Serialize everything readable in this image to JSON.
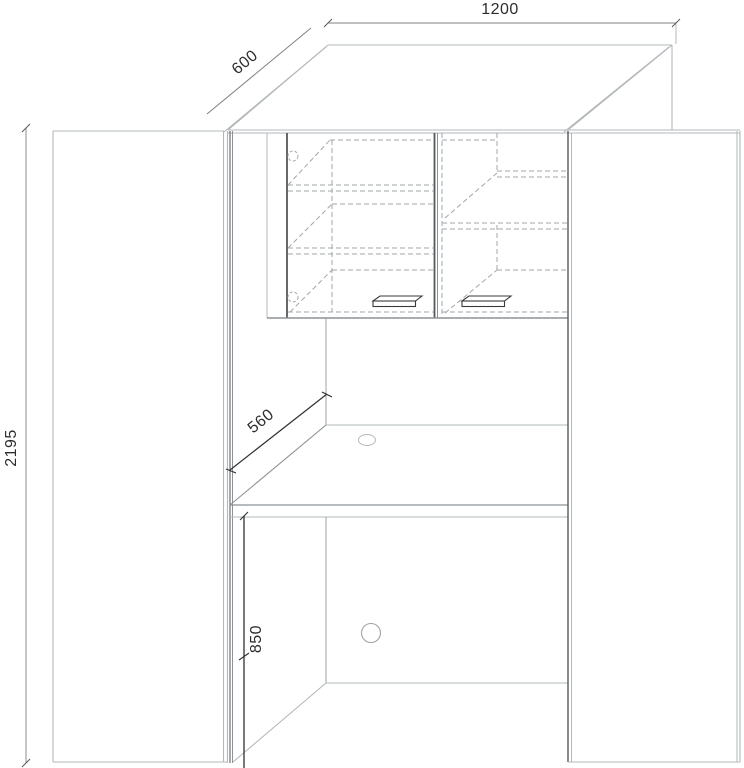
{
  "drawing": {
    "kind": "furniture-cabinet-desk-technical-drawing",
    "dimensions": {
      "cabinet_width": "1200",
      "cabinet_depth": "600",
      "cabinet_height": "2195",
      "desk_depth": "560",
      "desk_height": "850"
    },
    "units": "mm",
    "counts": {
      "door_handles": 2,
      "cable_grommets": 2,
      "upper_cabinet_doors": 2,
      "tall_side_doors": 2
    },
    "colors": {
      "background": "#ffffff",
      "line_light": "#b3b8bb",
      "line_medium": "#8d9296",
      "line_dark": "#55585a",
      "line_dashed": "#a2a7aa",
      "dimension_gray": "#7c8184",
      "dimension_dark": "#2f3133",
      "text": "#2b2d2f"
    }
  }
}
